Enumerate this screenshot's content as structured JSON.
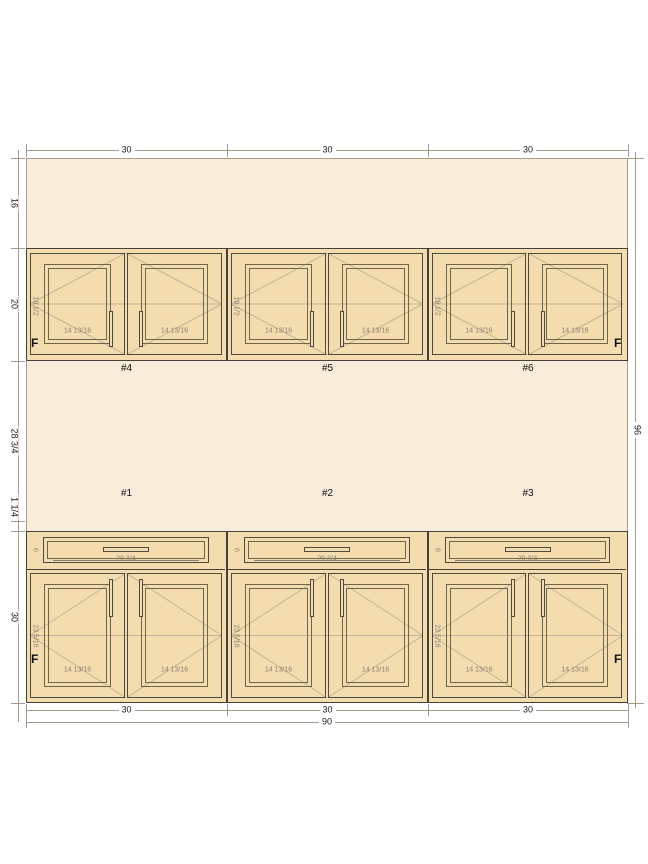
{
  "drawing_type": "cabinet-elevation",
  "colors": {
    "wall_fill": "#f9ecda",
    "cabinet_fill": "#f3ddae",
    "outline": "#45403a",
    "panel_line": "#6f6549",
    "swing_line": "#c4b397",
    "dim_line": "#a39b8d",
    "dim_text": "#1c1c1c",
    "inner_text": "#8b8172"
  },
  "dimensions": {
    "top_widths": [
      "30",
      "30",
      "30"
    ],
    "left_heights": [
      "16",
      "20",
      "28 3/4",
      "1 1/4",
      "30"
    ],
    "right_total_height": "96",
    "bottom_widths": [
      "30",
      "30",
      "30"
    ],
    "bottom_total_width": "90"
  },
  "upper_cabinets": [
    {
      "number": "#4",
      "height_label": "19 1/2",
      "door_width_labels": [
        "14 13/16",
        "14 13/16"
      ],
      "finished_end": "left",
      "finished_end_label": "F"
    },
    {
      "number": "#5",
      "height_label": "19 1/2",
      "door_width_labels": [
        "14 13/16",
        "14 13/16"
      ],
      "finished_end": "",
      "finished_end_label": ""
    },
    {
      "number": "#6",
      "height_label": "19 1/2",
      "door_width_labels": [
        "14 13/16",
        "14 13/16"
      ],
      "finished_end": "right",
      "finished_end_label": "F"
    }
  ],
  "base_cabinets": [
    {
      "number": "#1",
      "drawer_front_height_label": "6",
      "drawer_width_label": "29 3/4",
      "door_height_label": "23 5/16",
      "door_width_labels": [
        "14 13/16",
        "14 13/16"
      ],
      "finished_end": "left",
      "finished_end_label": "F"
    },
    {
      "number": "#2",
      "drawer_front_height_label": "6",
      "drawer_width_label": "29 3/4",
      "door_height_label": "23 5/16",
      "door_width_labels": [
        "14 13/16",
        "14 13/16"
      ],
      "finished_end": "",
      "finished_end_label": ""
    },
    {
      "number": "#3",
      "drawer_front_height_label": "6",
      "drawer_width_label": "29 3/4",
      "door_height_label": "23 5/16",
      "door_width_labels": [
        "14 13/16",
        "14 13/16"
      ],
      "finished_end": "right",
      "finished_end_label": "F"
    }
  ]
}
